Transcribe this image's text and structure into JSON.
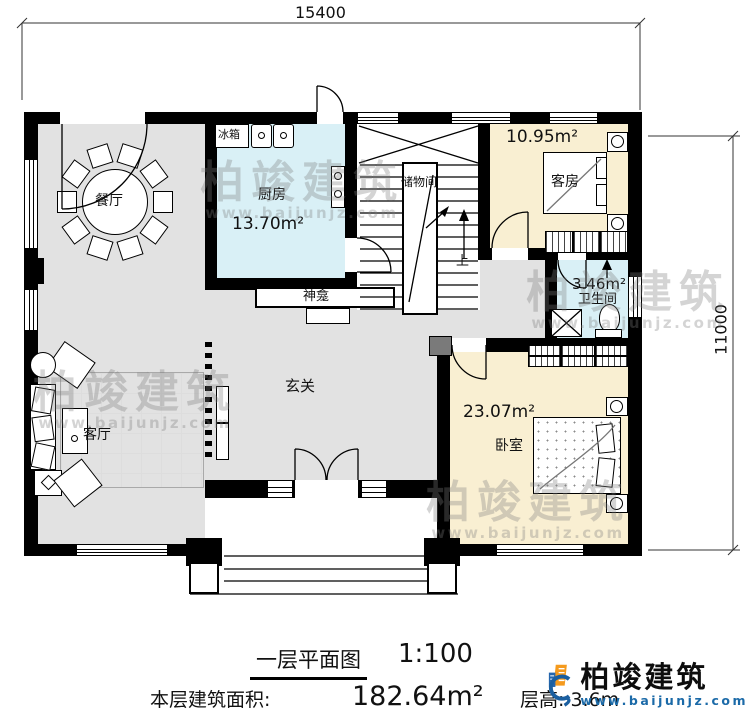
{
  "dimensions": {
    "width_label": "15400",
    "height_label": "11000"
  },
  "rooms": {
    "dining": {
      "name": "餐厅"
    },
    "kitchen": {
      "name": "厨房",
      "area": "13.70m²"
    },
    "storage": {
      "name": "储物间"
    },
    "guest": {
      "name": "客房",
      "area": "10.95m²"
    },
    "bathroom": {
      "name": "卫生间",
      "area": "3.46m²"
    },
    "hall": {
      "name": "玄关"
    },
    "living": {
      "name": "客厅"
    },
    "bedroom": {
      "name": "卧室",
      "area": "23.07m²"
    },
    "shrine": {
      "name": "神龛"
    },
    "fridge": {
      "name": "冰箱"
    },
    "stairs": {
      "up": "上"
    }
  },
  "footer": {
    "title": "一层平面图",
    "scale": "1:100",
    "floor_area_label": "本层建筑面积:",
    "floor_area_value": "182.64m²",
    "floor_height_label": "层高:",
    "floor_height_value": "3.6m"
  },
  "logo": {
    "name": "柏竣建筑",
    "website": "www.baijunjz.com"
  },
  "watermark": {
    "brand": "柏竣建筑",
    "website": "www.baijunjz.com"
  },
  "colors": {
    "floor_gray": "#e2e2e2",
    "room_blue": "#d9f0f6",
    "room_cream": "#f9efd2",
    "logo_blue": "#1b6aa8",
    "logo_orange": "#f59a1d",
    "wall_black": "#000000"
  }
}
